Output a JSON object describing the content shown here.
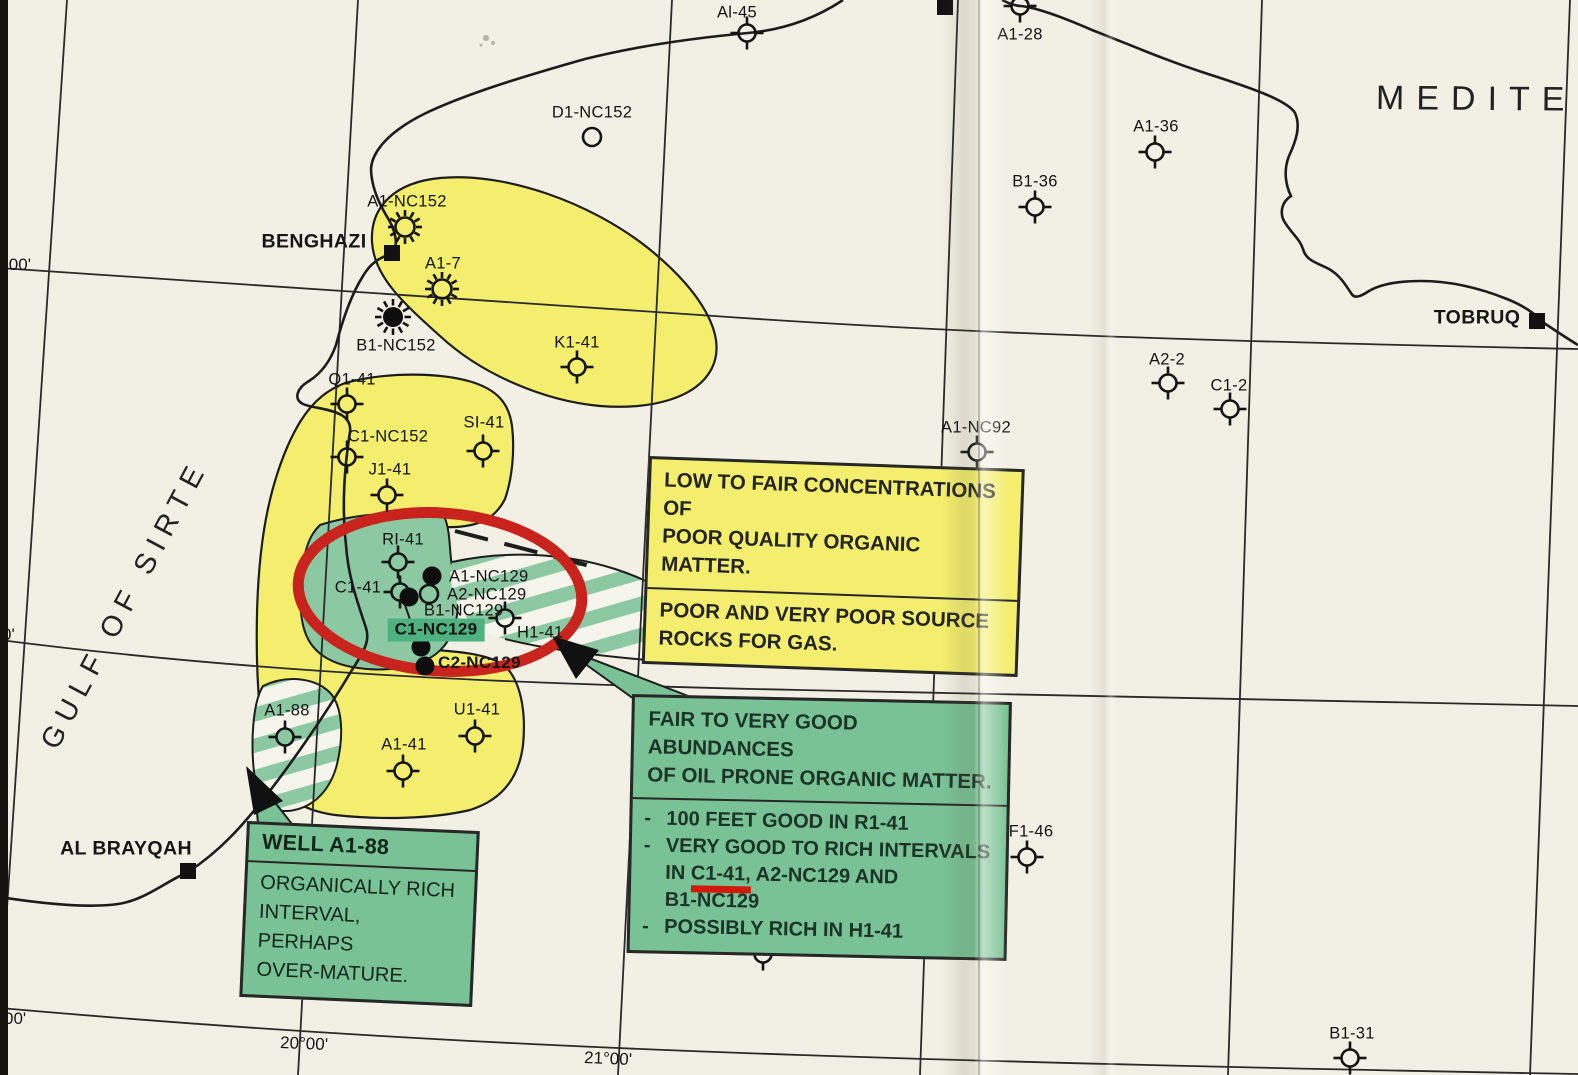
{
  "sea": {
    "label": "MEDITER"
  },
  "gulf": {
    "label": "GULF OF SIRTE"
  },
  "cities": [
    {
      "name": "BENGHAZI",
      "x": 392,
      "y": 253,
      "lx": 314,
      "ly": 242
    },
    {
      "name": "TOBRUQ",
      "x": 1537,
      "y": 321,
      "lx": 1477,
      "ly": 318
    },
    {
      "name": "AL BRAYQAH",
      "x": 188,
      "y": 871,
      "lx": 126,
      "ly": 849
    },
    {
      "name": "",
      "x": 945,
      "y": 7,
      "lx": 0,
      "ly": 0
    }
  ],
  "wells": [
    {
      "name": "Al-45",
      "x": 747,
      "y": 33,
      "type": "dry-hole",
      "lx": 737,
      "ly": 13
    },
    {
      "name": "A1-28",
      "x": 1020,
      "y": 6,
      "type": "dry-hole",
      "lx": 1020,
      "ly": 35
    },
    {
      "name": "D1-NC152",
      "x": 592,
      "y": 137,
      "type": "location",
      "lx": 592,
      "ly": 113
    },
    {
      "name": "A1-36",
      "x": 1155,
      "y": 152,
      "type": "dry-hole",
      "lx": 1156,
      "ly": 127
    },
    {
      "name": "B1-36",
      "x": 1035,
      "y": 207,
      "type": "dry-hole",
      "lx": 1035,
      "ly": 182
    },
    {
      "name": "A1-NC152",
      "x": 405,
      "y": 227,
      "type": "show",
      "lx": 407,
      "ly": 202
    },
    {
      "name": "A1-7",
      "x": 442,
      "y": 289,
      "type": "show",
      "lx": 443,
      "ly": 264
    },
    {
      "name": "B1-NC152",
      "x": 393,
      "y": 317,
      "type": "gas",
      "lx": 396,
      "ly": 346
    },
    {
      "name": "K1-41",
      "x": 577,
      "y": 367,
      "type": "dry-hole",
      "lx": 577,
      "ly": 343
    },
    {
      "name": "Q1-41",
      "x": 347,
      "y": 404,
      "type": "dry-hole",
      "lx": 352,
      "ly": 380
    },
    {
      "name": "C1-NC152",
      "x": 347,
      "y": 457,
      "type": "dry-hole",
      "lx": 388,
      "ly": 437
    },
    {
      "name": "SI-41",
      "x": 483,
      "y": 451,
      "type": "dry-hole",
      "lx": 484,
      "ly": 423
    },
    {
      "name": "J1-41",
      "x": 387,
      "y": 495,
      "type": "dry-hole",
      "lx": 390,
      "ly": 470
    },
    {
      "name": "RI-41",
      "x": 398,
      "y": 562,
      "type": "dry-hole",
      "lx": 403,
      "ly": 540
    },
    {
      "name": "C1-41",
      "x": 400,
      "y": 592,
      "type": "dry-hole",
      "lx": 358,
      "ly": 588
    },
    {
      "name": "A1-NC129",
      "x": 432,
      "y": 576,
      "type": "dot",
      "lx": 449,
      "ly": 577,
      "anchor": "l"
    },
    {
      "name": "A2-NC129",
      "x": 429,
      "y": 594,
      "type": "location",
      "lx": 447,
      "ly": 595,
      "anchor": "l"
    },
    {
      "name": "B1-NC129",
      "x": 409,
      "y": 597,
      "type": "dot",
      "lx": 424,
      "ly": 611,
      "anchor": "l"
    },
    {
      "name": "C1-NC129",
      "x": 421,
      "y": 647,
      "type": "dot",
      "lx": 436,
      "ly": 630,
      "bold": true,
      "bg": true
    },
    {
      "name": "C2-NC129",
      "x": 425,
      "y": 666,
      "type": "dot",
      "lx": 438,
      "ly": 663,
      "anchor": "l",
      "bold": true
    },
    {
      "name": "H1-41",
      "x": 505,
      "y": 618,
      "type": "dry-hole",
      "lx": 517,
      "ly": 633,
      "anchor": "l"
    },
    {
      "name": "A1-88",
      "x": 285,
      "y": 737,
      "type": "dry-hole",
      "lx": 287,
      "ly": 711
    },
    {
      "name": "U1-41",
      "x": 475,
      "y": 736,
      "type": "dry-hole",
      "lx": 477,
      "ly": 710
    },
    {
      "name": "A1-41",
      "x": 403,
      "y": 771,
      "type": "dry-hole",
      "lx": 404,
      "ly": 745
    },
    {
      "name": "F1-46",
      "x": 1027,
      "y": 857,
      "type": "dry-hole",
      "lx": 1031,
      "ly": 832
    },
    {
      "name": "A1-31",
      "x": 763,
      "y": 954,
      "type": "dry-hole",
      "lx": 765,
      "ly": 929
    },
    {
      "name": "B1-31",
      "x": 1350,
      "y": 1058,
      "type": "dry-hole",
      "lx": 1352,
      "ly": 1034
    },
    {
      "name": "A2-2",
      "x": 1168,
      "y": 383,
      "type": "dry-hole",
      "lx": 1167,
      "ly": 360
    },
    {
      "name": "C1-2",
      "x": 1230,
      "y": 409,
      "type": "dry-hole",
      "lx": 1229,
      "ly": 386
    },
    {
      "name": "A1-NC92",
      "x": 977,
      "y": 452,
      "type": "dry-hole",
      "lx": 976,
      "ly": 428
    }
  ],
  "graticule": {
    "lat_labels": [
      {
        "text": "°00'",
        "x": 2,
        "y": 265
      },
      {
        "text": "0'",
        "x": 2,
        "y": 635
      },
      {
        "text": "00'",
        "x": 4,
        "y": 1019
      }
    ],
    "lon_labels": [
      {
        "text": "20°00'",
        "x": 304,
        "y": 1044
      },
      {
        "text": "21°00'",
        "x": 608,
        "y": 1059
      }
    ]
  },
  "callouts": {
    "yellow_box": {
      "para1_lines": [
        "LOW TO FAIR CONCENTRATIONS OF",
        "POOR QUALITY ORGANIC MATTER."
      ],
      "para2_lines": [
        "POOR AND VERY POOR SOURCE",
        "ROCKS FOR GAS."
      ]
    },
    "green_box": {
      "header_lines": [
        "FAIR TO VERY GOOD ABUNDANCES",
        "OF OIL PRONE ORGANIC MATTER."
      ],
      "bullet_dash": "-",
      "bullet1_lines": [
        "100 FEET GOOD IN R1-41"
      ],
      "bullet2": {
        "pre": "VERY GOOD TO RICH INTERVALS\nIN ",
        "underline": "C1-41,",
        "post": " A2-NC129 AND\nB1-NC129"
      },
      "bullet3_lines": [
        "POSSIBLY RICH IN H1-41"
      ]
    },
    "a188_box": {
      "title": "WELL A1-88",
      "body_lines": [
        "ORGANICALLY RICH",
        "INTERVAL, PERHAPS",
        "OVER-MATURE."
      ]
    }
  },
  "colors": {
    "paper": "#f2efe4",
    "area_yellow": "#f3ee6d",
    "area_green": "#8cc9a3",
    "box_green": "#79c295",
    "label_highlight_green": "#4db180",
    "annotation_red": "#c8231c",
    "ink": "#161616"
  }
}
